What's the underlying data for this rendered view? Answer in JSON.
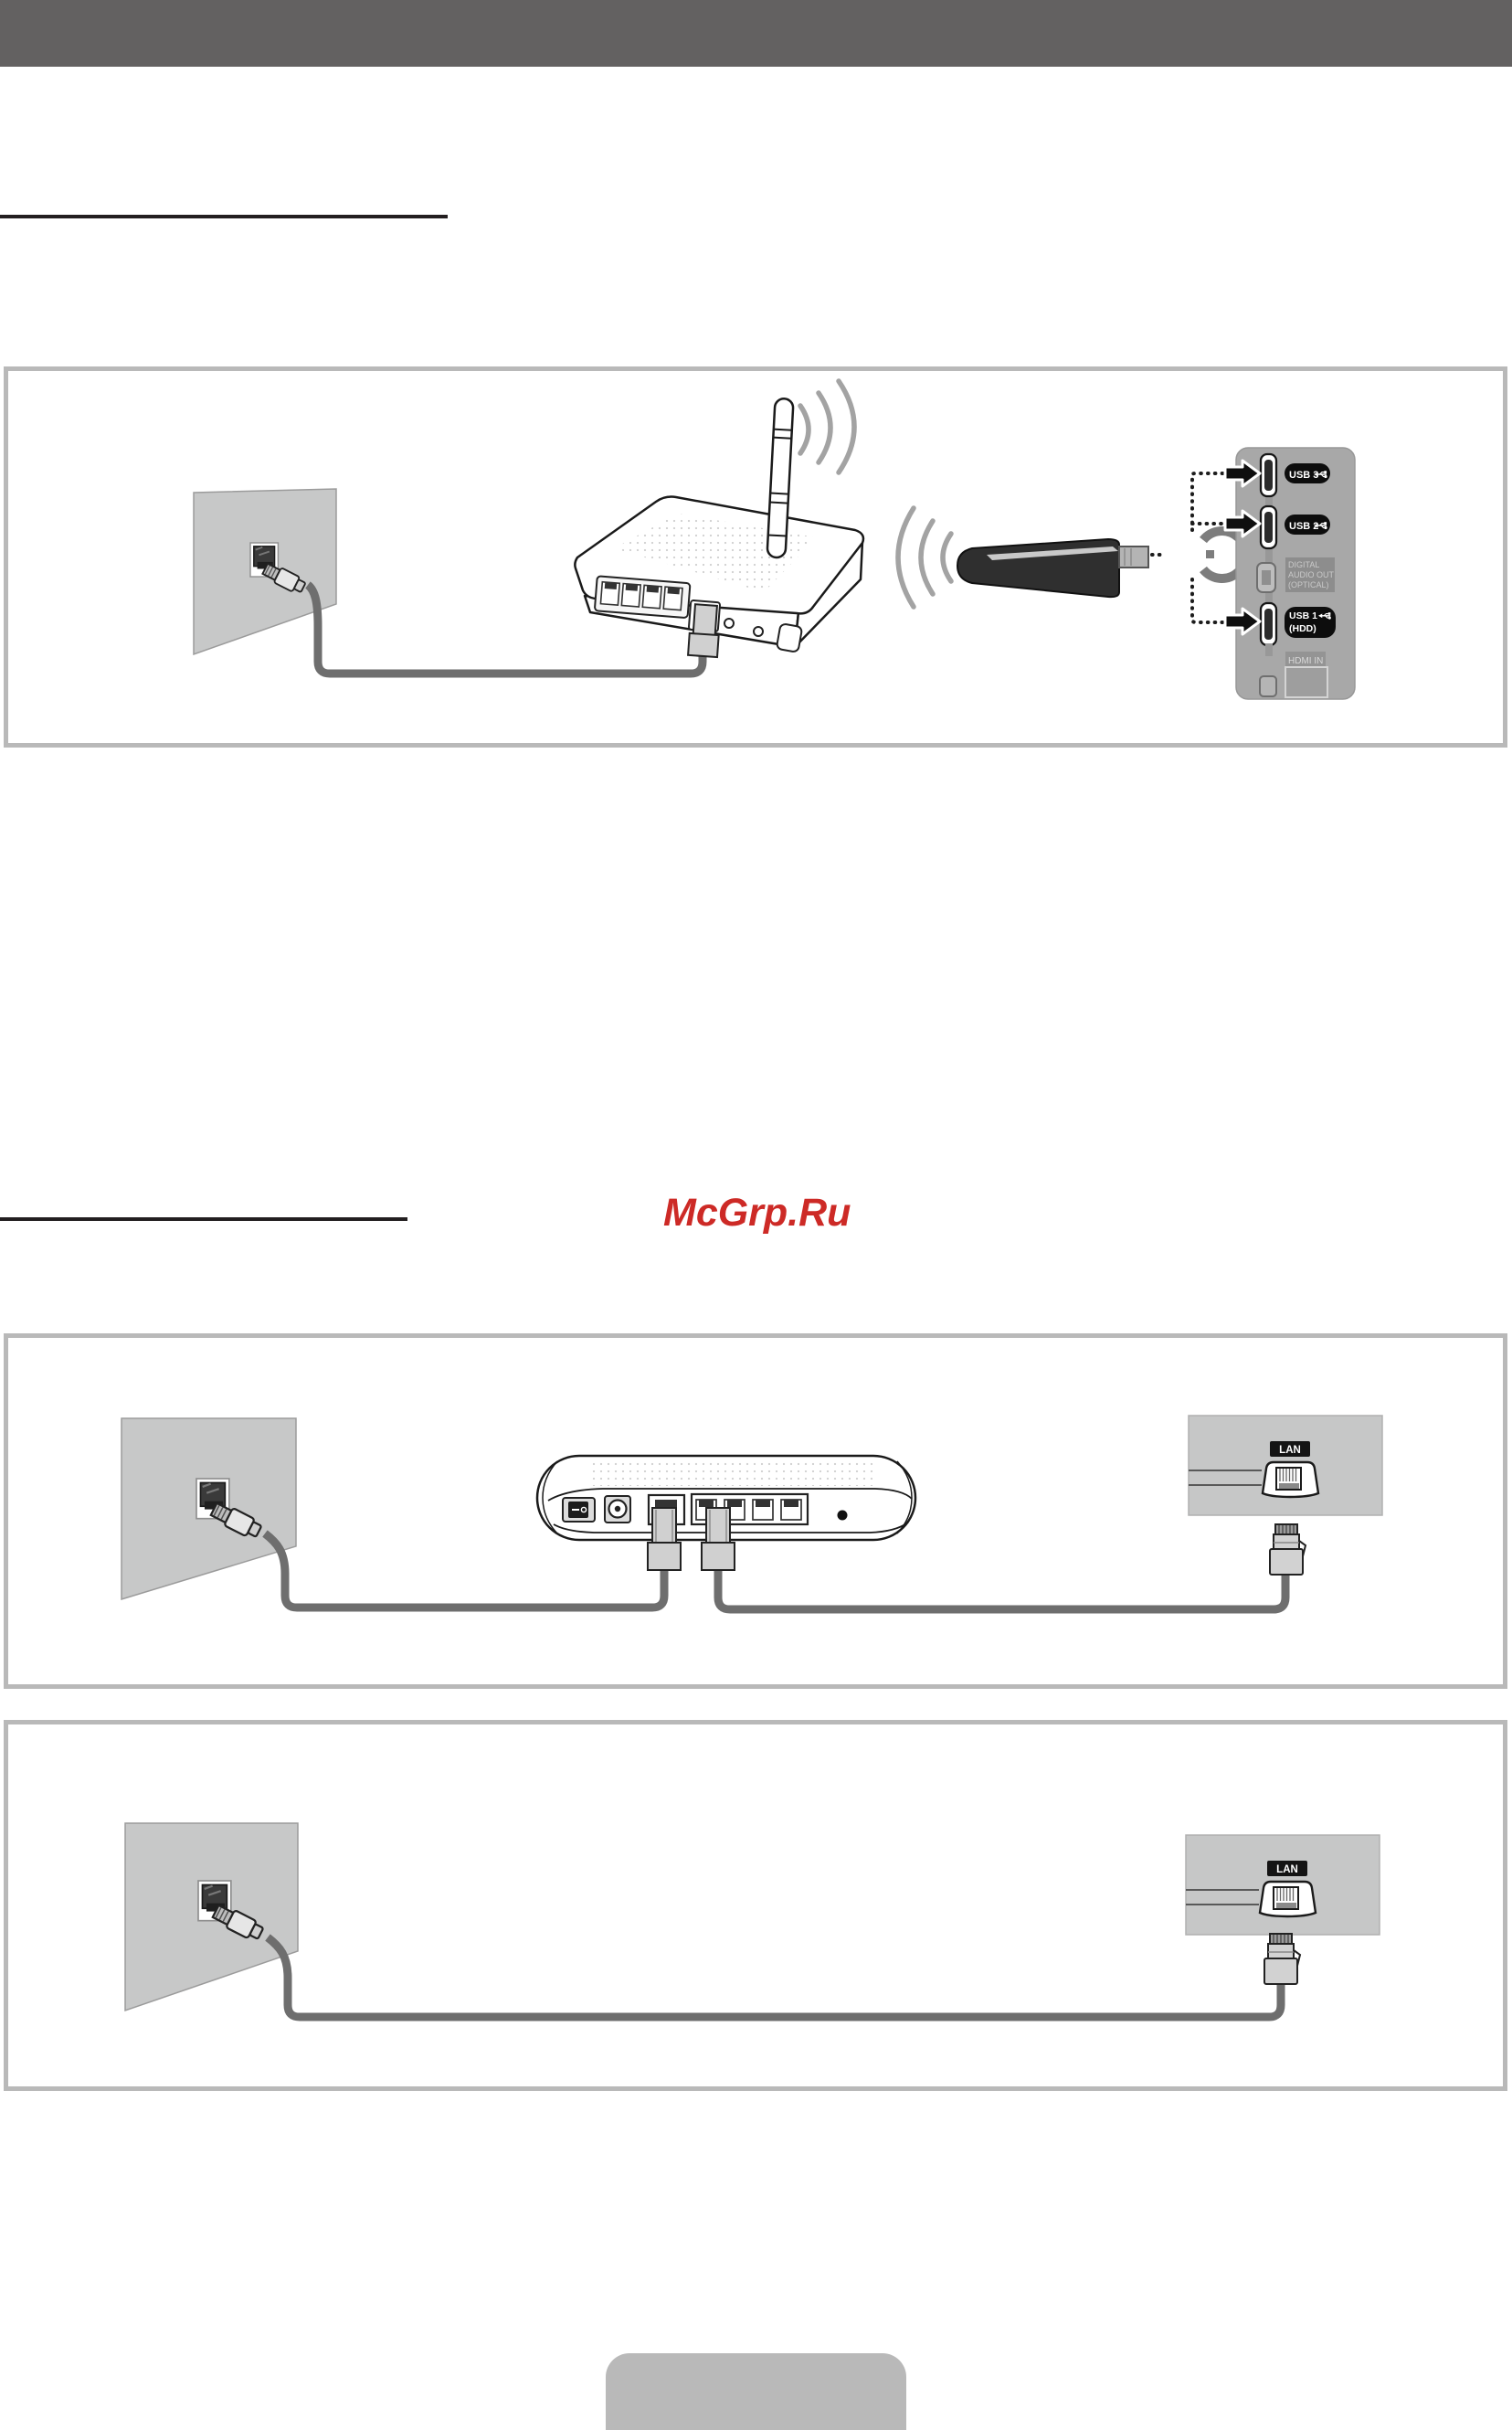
{
  "colors": {
    "top_bar": "#636161",
    "rule": "#231f20",
    "frame": "#b9b9b9",
    "wall": "#c7c8c8",
    "cable": "#6e6e6e",
    "tv_panel": "#a8a8a8",
    "lan_panel": "#c6c7c7",
    "watermark_red": "#cd2a26"
  },
  "watermark": {
    "text": "McGrp.Ru"
  },
  "diagram_wireless": {
    "tv_panel": {
      "usb3": "USB 3",
      "usb2": "USB 2",
      "digital_audio_line1": "DIGITAL",
      "digital_audio_line2": "AUDIO OUT",
      "digital_audio_line3": "(OPTICAL)",
      "usb1_line1": "USB 1",
      "usb1_line2": "(HDD)",
      "hdmi": "HDMI IN"
    }
  },
  "diagram_wired_router": {
    "lan_label": "LAN"
  },
  "diagram_wired_direct": {
    "lan_label": "LAN"
  }
}
